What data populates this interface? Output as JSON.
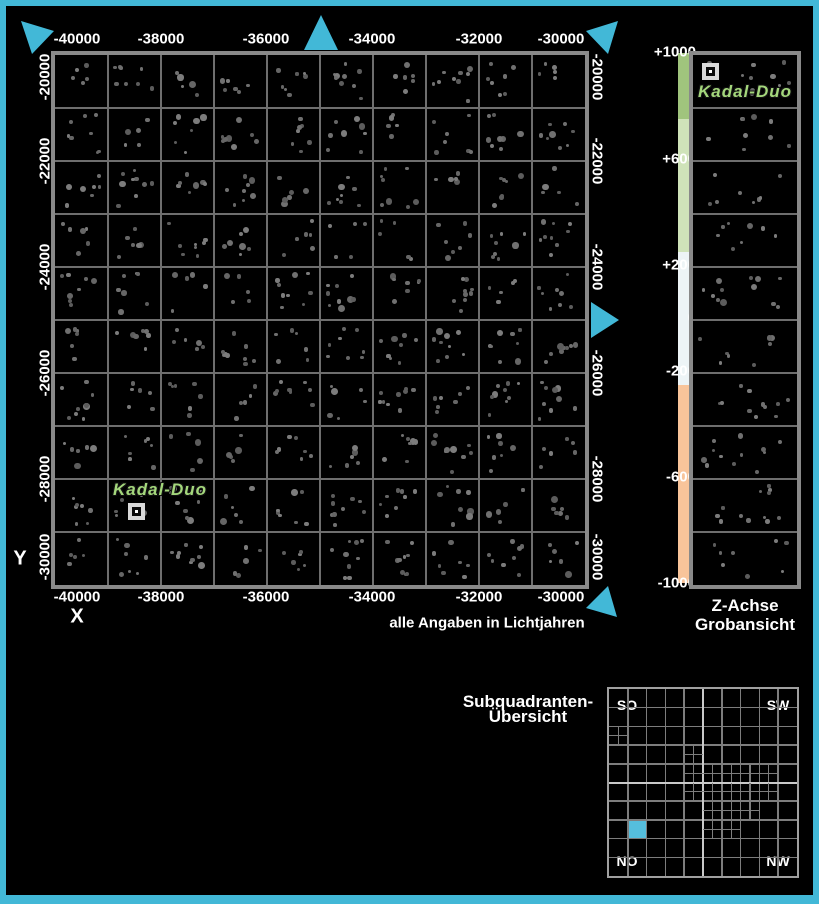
{
  "colors": {
    "accent": "#42b8d7",
    "map_border": "#898989",
    "grid_line": "#6e6e6e",
    "system_label_color": "#a4d77c",
    "subq_highlight": "#55bedd",
    "star_grays": [
      "#5c5c5c",
      "#666666",
      "#707070",
      "#7c7c7c"
    ]
  },
  "main_map": {
    "axis_x_title": "X",
    "axis_y_title": "Y",
    "units_note": "alle Angaben in Lichtjahren",
    "x_ticks": [
      {
        "label": "-40000",
        "px": 77
      },
      {
        "label": "-38000",
        "px": 161
      },
      {
        "label": "-36000",
        "px": 266
      },
      {
        "label": "-34000",
        "px": 372
      },
      {
        "label": "-32000",
        "px": 479
      },
      {
        "label": "-30000",
        "px": 561
      }
    ],
    "y_ticks": [
      {
        "label": "-20000",
        "py": 77
      },
      {
        "label": "-22000",
        "py": 161
      },
      {
        "label": "-24000",
        "py": 267
      },
      {
        "label": "-26000",
        "py": 373
      },
      {
        "label": "-28000",
        "py": 479
      },
      {
        "label": "-30000",
        "py": 557
      }
    ],
    "grid_cols": 10,
    "grid_rows": 10,
    "system": {
      "name": "Kadal-Duo"
    }
  },
  "z_panel": {
    "caption_line1": "Z-Achse",
    "caption_line2": "Grobansicht",
    "ticks": [
      {
        "label": "+1000",
        "py": 52
      },
      {
        "label": "+600",
        "py": 159
      },
      {
        "label": "+200",
        "py": 265
      },
      {
        "label": "0",
        "py": 318
      },
      {
        "label": "-200",
        "py": 371
      },
      {
        "label": "-600",
        "py": 477
      },
      {
        "label": "-1000",
        "py": 583
      }
    ],
    "bands": [
      {
        "color": "#a0c47d",
        "height": 66
      },
      {
        "color": "#cfe3b9",
        "height": 133
      },
      {
        "color": "#edf4f6",
        "height": 133
      },
      {
        "color": "#f8c49a",
        "height": 198
      }
    ],
    "grid_rows": 10,
    "system_name": "Kadal-Duo"
  },
  "subquadrant_panel": {
    "title_line1": "Subquadranten-",
    "title_line2": "Übersicht",
    "corner_labels": {
      "top_left": "SO",
      "top_right": "SW",
      "bottom_left": "NO",
      "bottom_right": "NW"
    },
    "grid_cols": 10,
    "grid_rows": 10,
    "highlighted_cell": {
      "row": 7,
      "col": 1
    },
    "subdivided_cells": [
      [
        2,
        0
      ],
      [
        3,
        4
      ],
      [
        4,
        4
      ],
      [
        4,
        5
      ],
      [
        4,
        6
      ],
      [
        4,
        7
      ],
      [
        4,
        8
      ],
      [
        5,
        4
      ],
      [
        5,
        5
      ],
      [
        5,
        6
      ],
      [
        5,
        7
      ],
      [
        5,
        8
      ],
      [
        6,
        5
      ],
      [
        6,
        6
      ],
      [
        6,
        7
      ],
      [
        7,
        5
      ],
      [
        7,
        6
      ]
    ]
  },
  "nav_arrows": [
    {
      "id": "north-west",
      "points": "21,21 54,31 32,54"
    },
    {
      "id": "north",
      "points": "321,15 304,50 338,50"
    },
    {
      "id": "north-east",
      "points": "618,21 586,31 608,54"
    },
    {
      "id": "east",
      "points": "619,320 591,302 591,338"
    },
    {
      "id": "south-east",
      "points": "617,617 586,608 608,586"
    }
  ],
  "starfield": {
    "seed": 1337,
    "main_min_per_cell": 5,
    "main_max_per_cell": 9,
    "strip_min_per_cell": 8,
    "strip_max_per_cell": 12
  }
}
